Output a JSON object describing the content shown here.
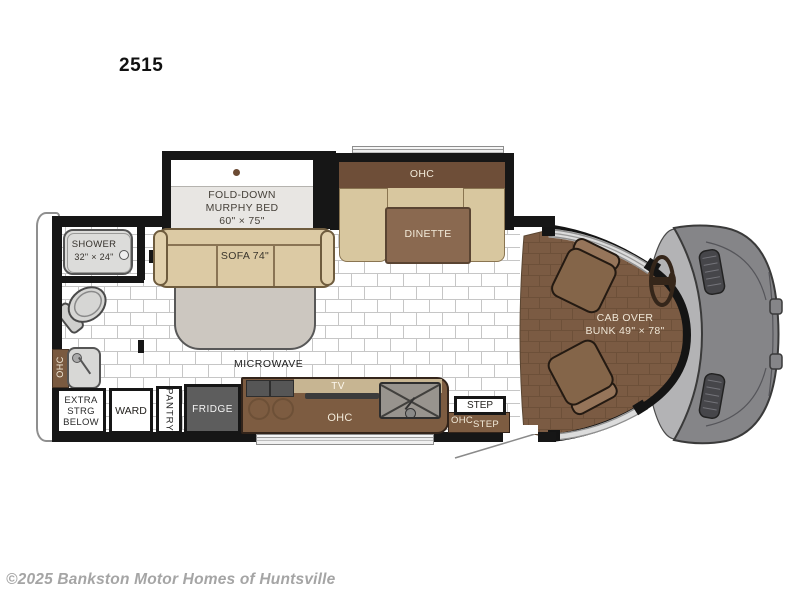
{
  "model_label": "2515",
  "watermark": "©2025 Bankston Motor Homes of Huntsville",
  "colors": {
    "wall": "#161616",
    "tan_furniture": "#dccaa4",
    "brown_cabinet": "#7d5c41",
    "dark_brown_ohc": "#6e4e38",
    "cab_floor_brown": "#7b5b43",
    "van_gray": "#858588",
    "fridge_gray": "#5d5d5d",
    "tile_grout": "#c6c6c6"
  },
  "labels": {
    "murphy_bed": {
      "l1": "FOLD-DOWN",
      "l2": "MURPHY BED",
      "l3": "60\" × 75\""
    },
    "sofa": "SOFA 74\"",
    "dinette_ohc": "OHC",
    "dinette": "DINETTE",
    "shower_l1": "SHOWER",
    "shower_l2": "32\" × 24\"",
    "rear_ohc": "OHC",
    "extra_strg": {
      "l1": "EXTRA",
      "l2": "STRG",
      "l3": "BELOW"
    },
    "ward": "WARD",
    "pantry": "PANTRY",
    "fridge": "FRIDGE",
    "microwave": "MICROWAVE",
    "tv": "TV",
    "kitchen_ohc": "OHC",
    "step_box": "STEP",
    "entry_ohc": "OHC",
    "entry_step": "STEP",
    "cab_l1": "CAB OVER",
    "cab_l2": "BUNK 49\" × 78\""
  }
}
